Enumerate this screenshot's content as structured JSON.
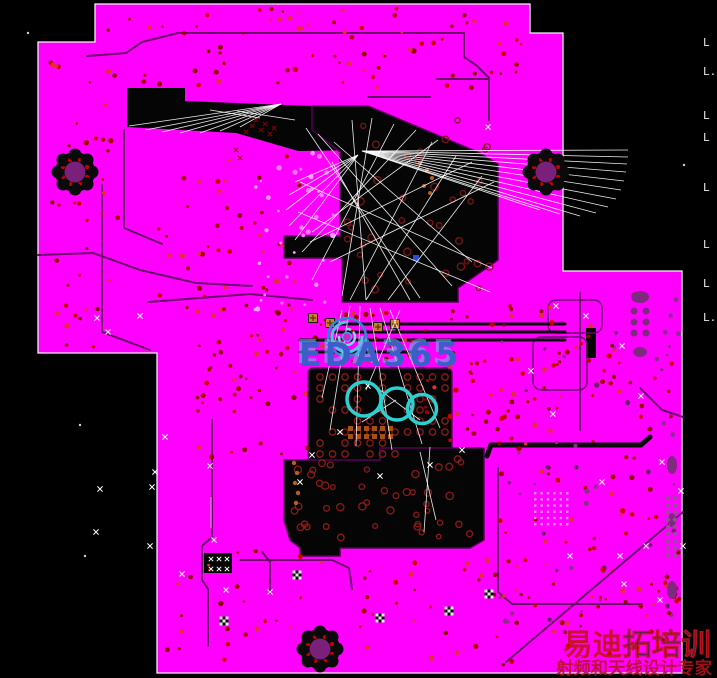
{
  "canvas": {
    "description": "PCB layout editor canvas, inner power/ground plane layer view",
    "plane_color": "#FF00FF",
    "background_color": "#000000",
    "trace_color": "#6B006B",
    "via_color": "#C80000",
    "ratsnest_color": "#FFFFFF",
    "highlight_color": "#2BD0D0"
  },
  "watermark_center": {
    "text": "EDA365",
    "color": "#3A5FC8"
  },
  "watermark_corner": {
    "line1_a": "易迪",
    "line1_b": "拓培训",
    "line2": "射频和天线设计专家",
    "red": "#C41420",
    "navy": "#1B2B52"
  },
  "layer_labels": [
    {
      "text": "L"
    },
    {
      "text": "L."
    },
    {
      "text": "L"
    },
    {
      "text": "L"
    },
    {
      "text": "L"
    },
    {
      "text": "L"
    },
    {
      "text": "L"
    },
    {
      "text": "L."
    }
  ],
  "markers": {
    "highlight_circle_count": 3,
    "mounting_hole_count": 3
  }
}
